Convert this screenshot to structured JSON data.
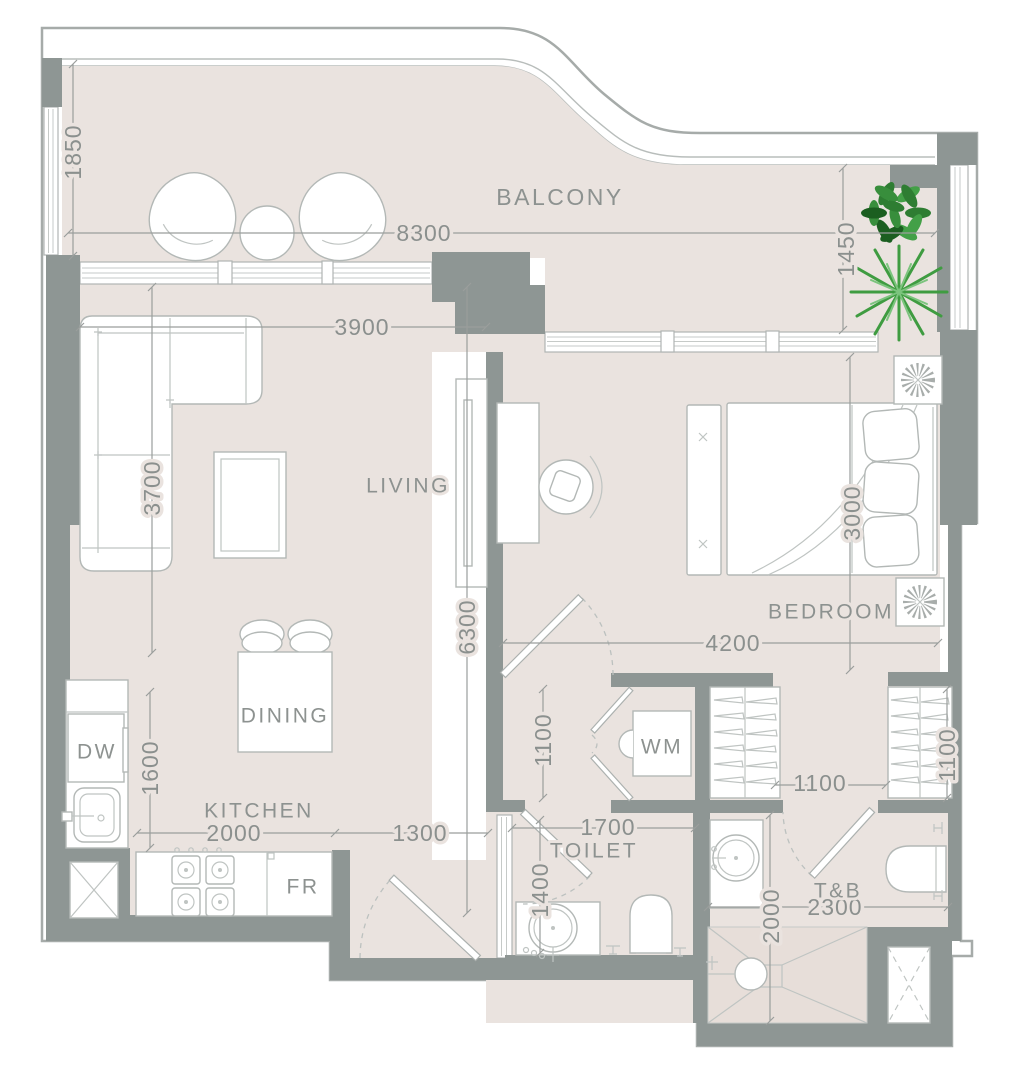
{
  "plan": {
    "type": "apartment-floor-plan",
    "rooms": {
      "balcony": "BALCONY",
      "living": "LIVING",
      "bedroom": "BEDROOM",
      "dining": "DINING",
      "kitchen": "KITCHEN",
      "toilet": "TOILET",
      "tb": "T&B",
      "wm": "WM",
      "dw": "DW",
      "fr": "FR"
    },
    "dimensions": {
      "balcony_depth": "1850",
      "balcony_width": "8300",
      "balcony_right_depth": "1450",
      "living_width": "3900",
      "living_depth": "3700",
      "unit_depth": "6300",
      "bedroom_depth": "3000",
      "bedroom_width": "4200",
      "hall_length": "1100",
      "closet_gap": "1100",
      "wardrobe_depth": "1100",
      "kitchen_depth": "1600",
      "kitchen_width": "2000",
      "entry_width": "1300",
      "toilet_width": "1700",
      "toilet_depth": "1400",
      "tb_depth": "2000",
      "tb_width": "2300"
    },
    "colors": {
      "wall": "#8e9694",
      "floor": "#eae3df",
      "outline": "#a6aba9",
      "furniture_line": "#b3b8b6",
      "text": "#8b908e",
      "plant_dark": "#1b5e20",
      "plant_light": "#43a047"
    }
  }
}
